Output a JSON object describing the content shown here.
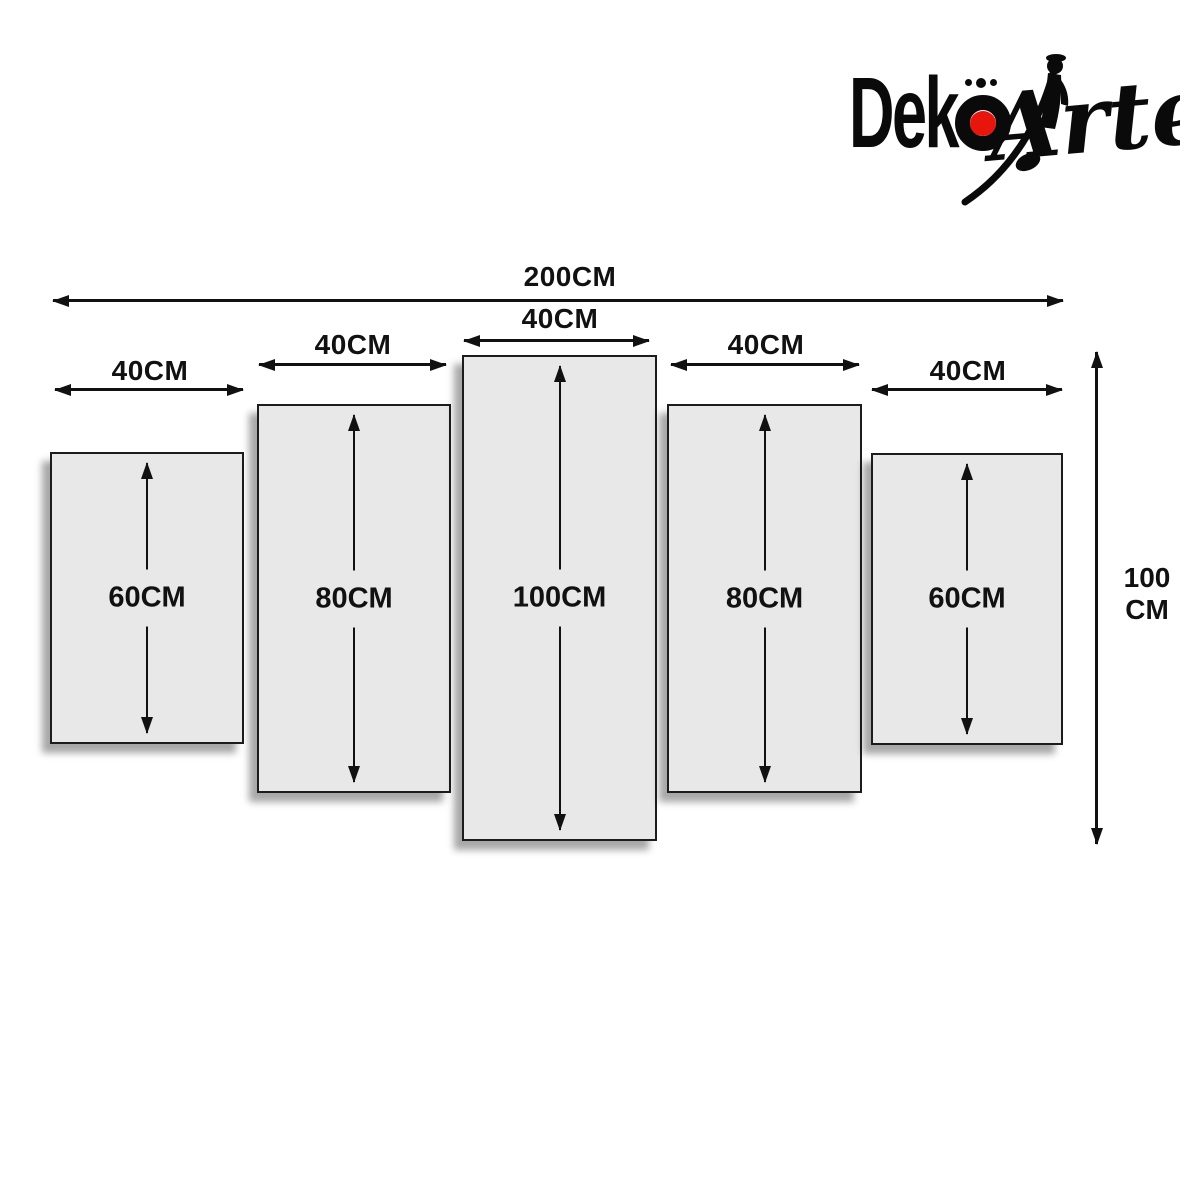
{
  "brand": {
    "name": "DekoArte",
    "deko_prefix": "Dek",
    "deko_o_char": "ö",
    "arte_script": "Arte",
    "accent_red": "#e8150d"
  },
  "dimensions": {
    "total_width_label": "200CM",
    "total_height_line1": "100",
    "total_height_line2": "CM"
  },
  "panels": [
    {
      "position": "far-left",
      "width_label": "40CM",
      "height_label": "60CM"
    },
    {
      "position": "left",
      "width_label": "40CM",
      "height_label": "80CM"
    },
    {
      "position": "center",
      "width_label": "40CM",
      "height_label": "100CM"
    },
    {
      "position": "right",
      "width_label": "40CM",
      "height_label": "80CM"
    },
    {
      "position": "far-right",
      "width_label": "40CM",
      "height_label": "60CM"
    }
  ],
  "colors": {
    "panel_fill": "#e8e8e8",
    "panel_border": "#1c1c1c",
    "line": "#111111",
    "background": "#ffffff",
    "logo_black": "#0a0a0a",
    "logo_red": "#e8150d"
  }
}
